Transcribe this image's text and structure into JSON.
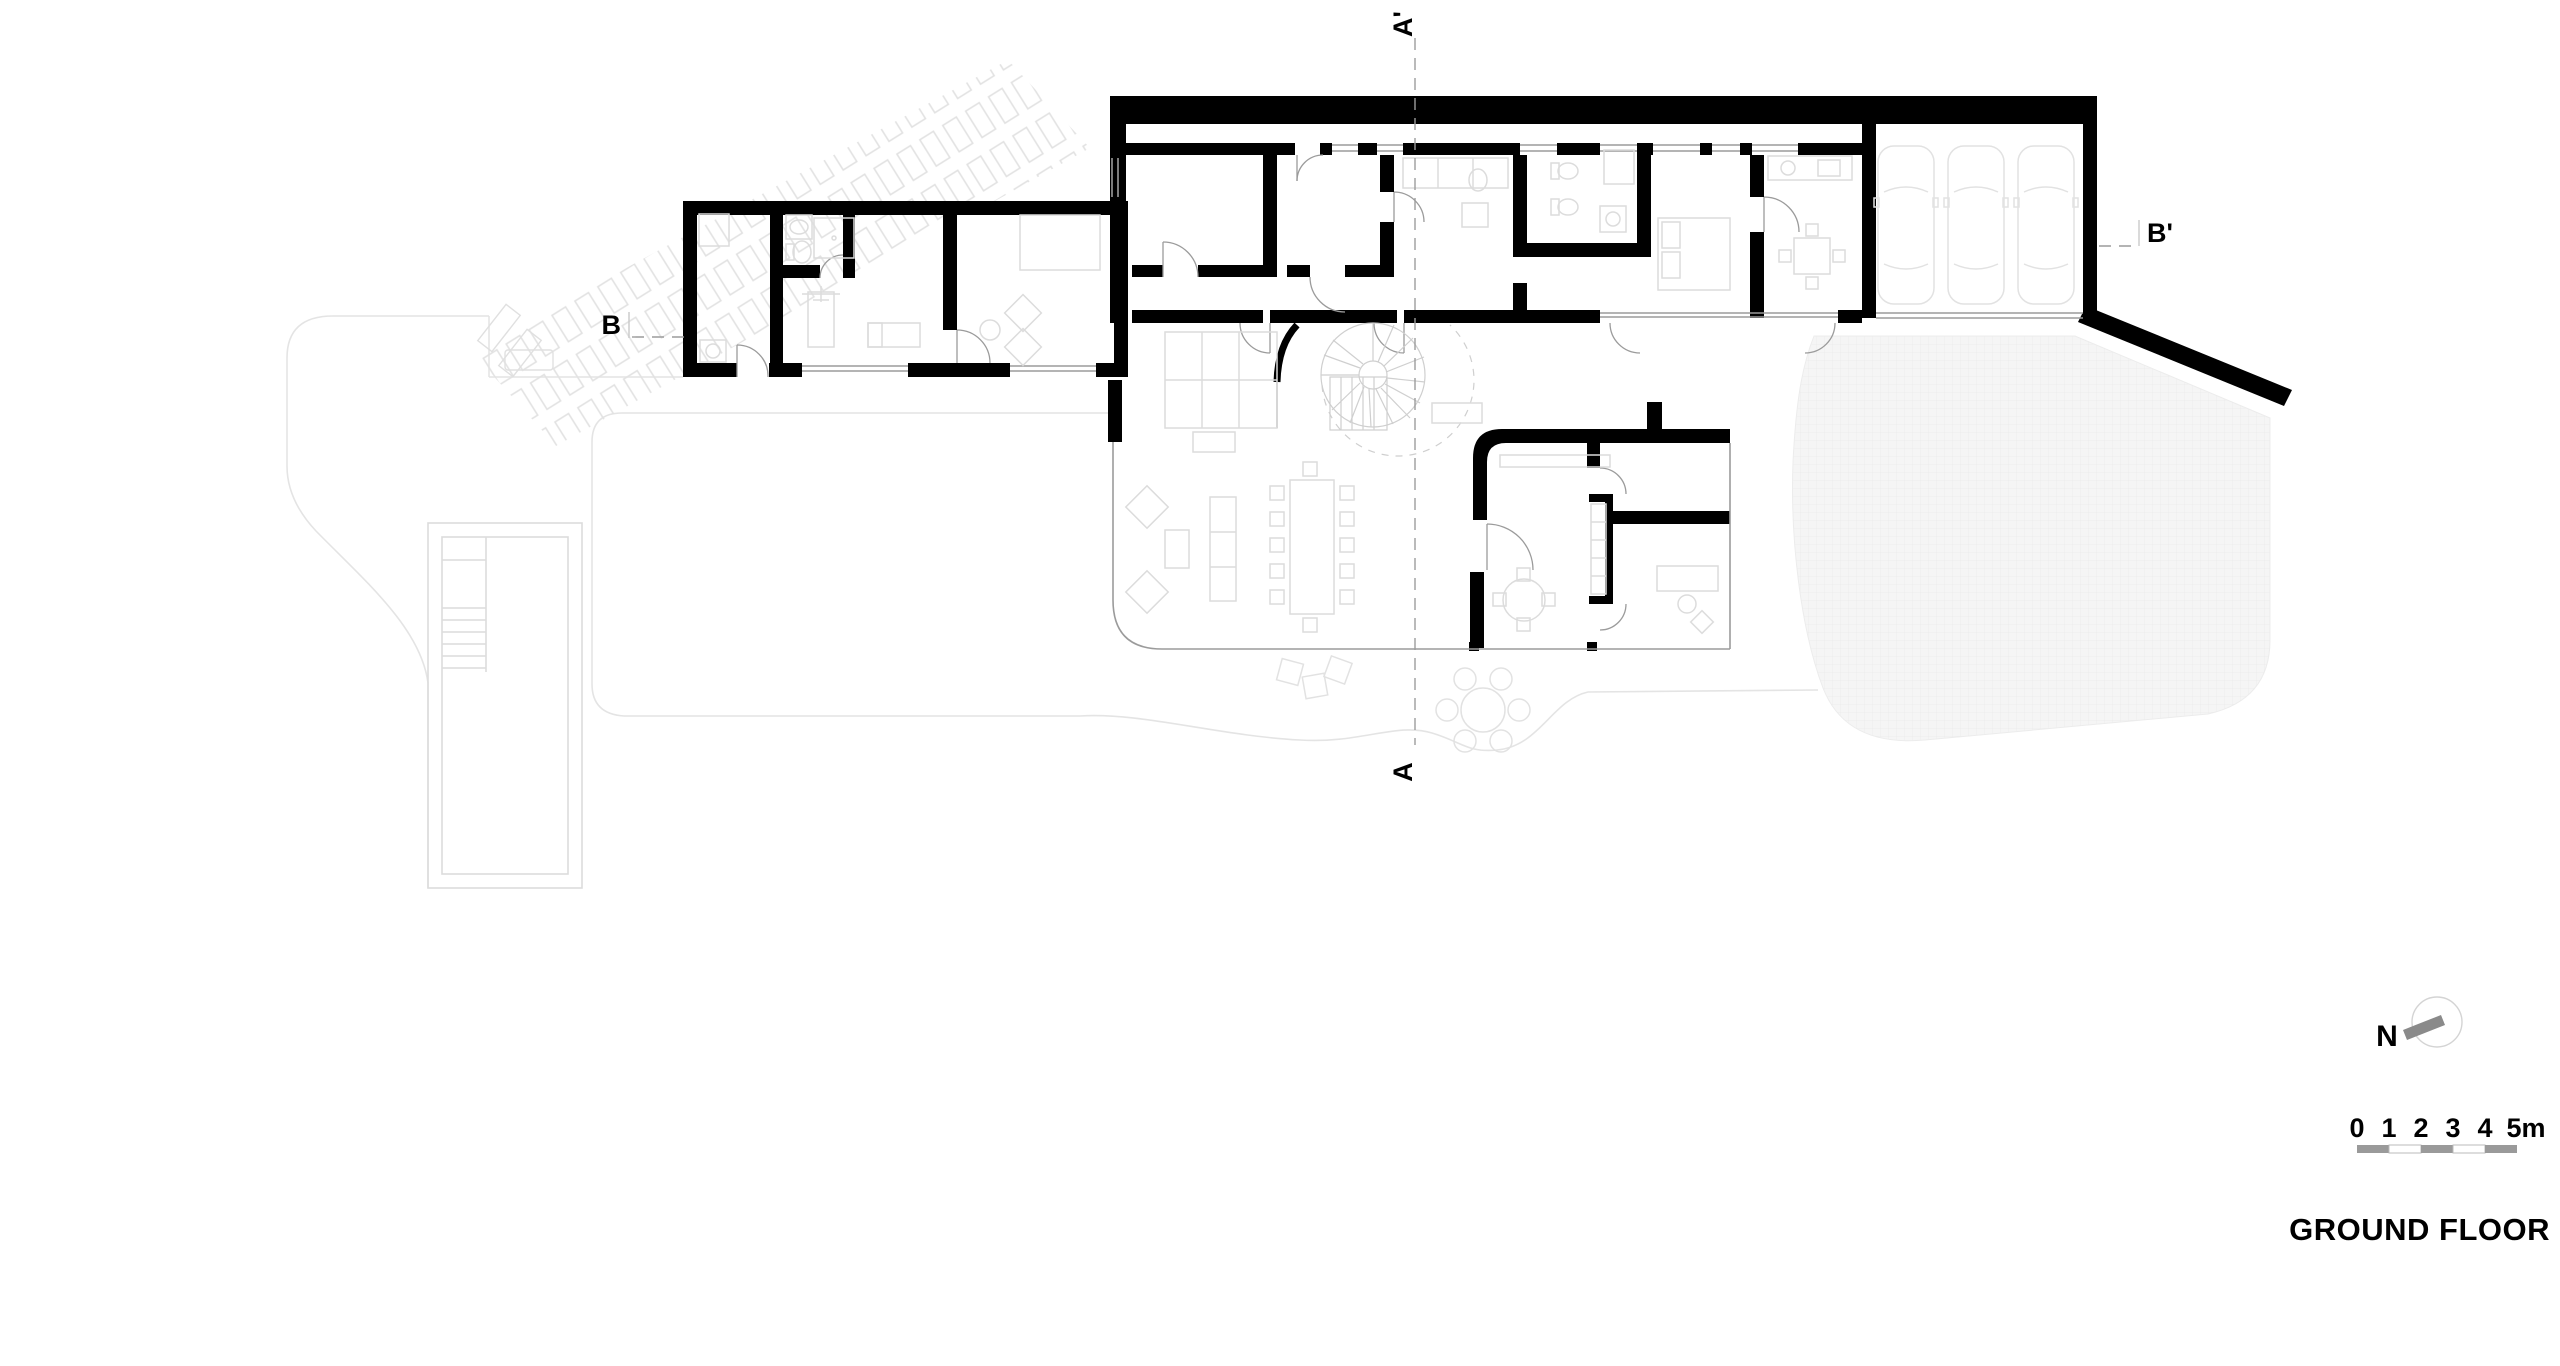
{
  "drawing": {
    "title": "GROUND FLOOR",
    "north_label": "N",
    "scale": {
      "labels": [
        "0",
        "1",
        "2",
        "3",
        "4",
        "5m"
      ]
    },
    "sections": {
      "a_top": "A'",
      "a_bottom": "A",
      "b_left": "B",
      "b_right": "B'"
    },
    "colors": {
      "wall": "#000000",
      "furniture_line": "#dcdcdc",
      "terrain_line": "#e4e4e4",
      "driveway_fill": "#f5f5f5",
      "scale_gray": "#9a9a9a",
      "needle_gray": "#8a8a8a"
    }
  }
}
